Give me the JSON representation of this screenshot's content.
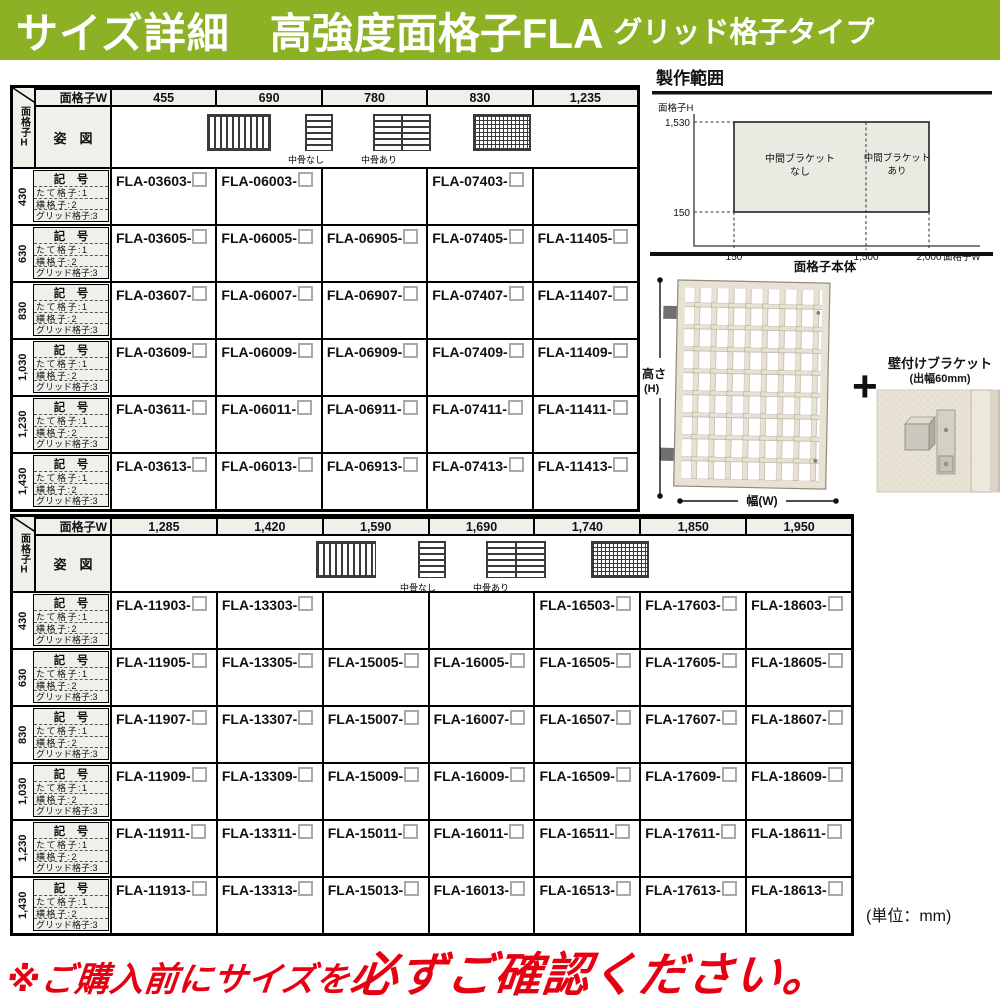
{
  "banner": {
    "title": "サイズ詳細",
    "product": "高強度面格子FLA",
    "type_label": "グリッド格子タイプ"
  },
  "corner": {
    "top": "面格子W",
    "side": "面格子H",
    "pose": "姿　図"
  },
  "row_labels": {
    "code": "記　号",
    "l1": "たて格子:1",
    "l2": "横格子:2",
    "l3": "グリッド格子:3"
  },
  "legend": {
    "no_mid": "中骨なし",
    "with_mid": "中骨あり"
  },
  "table1": {
    "widths": [
      "455",
      "690",
      "780",
      "830",
      "1,235"
    ],
    "rows": [
      {
        "height": "430",
        "codes": [
          "FLA-03603-",
          "FLA-06003-",
          "",
          "FLA-07403-",
          ""
        ]
      },
      {
        "height": "630",
        "codes": [
          "FLA-03605-",
          "FLA-06005-",
          "FLA-06905-",
          "FLA-07405-",
          "FLA-11405-"
        ]
      },
      {
        "height": "830",
        "codes": [
          "FLA-03607-",
          "FLA-06007-",
          "FLA-06907-",
          "FLA-07407-",
          "FLA-11407-"
        ]
      },
      {
        "height": "1,030",
        "codes": [
          "FLA-03609-",
          "FLA-06009-",
          "FLA-06909-",
          "FLA-07409-",
          "FLA-11409-"
        ]
      },
      {
        "height": "1,230",
        "codes": [
          "FLA-03611-",
          "FLA-06011-",
          "FLA-06911-",
          "FLA-07411-",
          "FLA-11411-"
        ]
      },
      {
        "height": "1,430",
        "codes": [
          "FLA-03613-",
          "FLA-06013-",
          "FLA-06913-",
          "FLA-07413-",
          "FLA-11413-"
        ]
      }
    ]
  },
  "table2": {
    "widths": [
      "1,285",
      "1,420",
      "1,590",
      "1,690",
      "1,740",
      "1,850",
      "1,950"
    ],
    "rows": [
      {
        "height": "430",
        "codes": [
          "FLA-11903-",
          "FLA-13303-",
          "",
          "",
          "FLA-16503-",
          "FLA-17603-",
          "FLA-18603-"
        ]
      },
      {
        "height": "630",
        "codes": [
          "FLA-11905-",
          "FLA-13305-",
          "FLA-15005-",
          "FLA-16005-",
          "FLA-16505-",
          "FLA-17605-",
          "FLA-18605-"
        ]
      },
      {
        "height": "830",
        "codes": [
          "FLA-11907-",
          "FLA-13307-",
          "FLA-15007-",
          "FLA-16007-",
          "FLA-16507-",
          "FLA-17607-",
          "FLA-18607-"
        ]
      },
      {
        "height": "1,030",
        "codes": [
          "FLA-11909-",
          "FLA-13309-",
          "FLA-15009-",
          "FLA-16009-",
          "FLA-16509-",
          "FLA-17609-",
          "FLA-18609-"
        ]
      },
      {
        "height": "1,230",
        "codes": [
          "FLA-11911-",
          "FLA-13311-",
          "FLA-15011-",
          "FLA-16011-",
          "FLA-16511-",
          "FLA-17611-",
          "FLA-18611-"
        ]
      },
      {
        "height": "1,430",
        "codes": [
          "FLA-11913-",
          "FLA-13313-",
          "FLA-15013-",
          "FLA-16013-",
          "FLA-16513-",
          "FLA-17613-",
          "FLA-18613-"
        ]
      }
    ]
  },
  "production_range": {
    "title": "製作範囲",
    "ylabel": "面格子H",
    "xlabel": "面格子W",
    "y_tick_top": "1,530",
    "y_tick_bottom": "150",
    "x_tick_1": "150",
    "x_tick_2": "1,500",
    "x_tick_3": "2,000",
    "x_range_mm": [
      150,
      2000
    ],
    "y_range_mm": [
      150,
      1530
    ],
    "zones": [
      {
        "line1": "中間ブラケット",
        "line2": "なし",
        "x_from_mm": 150,
        "x_to_mm": 1500
      },
      {
        "line1": "中間ブラケット",
        "line2": "あり",
        "x_from_mm": 1500,
        "x_to_mm": 2000
      }
    ]
  },
  "illustration": {
    "body_label": "面格子本体",
    "height_label": "高さ",
    "height_sub": "(H)",
    "width_label": "幅(W)",
    "plus": "+",
    "bracket_title": "壁付けブラケット",
    "bracket_sub": "(出幅60mm)"
  },
  "unit_note": "(単位：mm)",
  "warning": {
    "lead": "※ご購入前にサイズを",
    "strong": "必ずご確認ください",
    "period": "。"
  },
  "colors": {
    "banner_green": "#8CB125",
    "warning_red": "#E60012",
    "cell_gray": "#F0F0EA",
    "range_fill": "#E9EBE3"
  }
}
